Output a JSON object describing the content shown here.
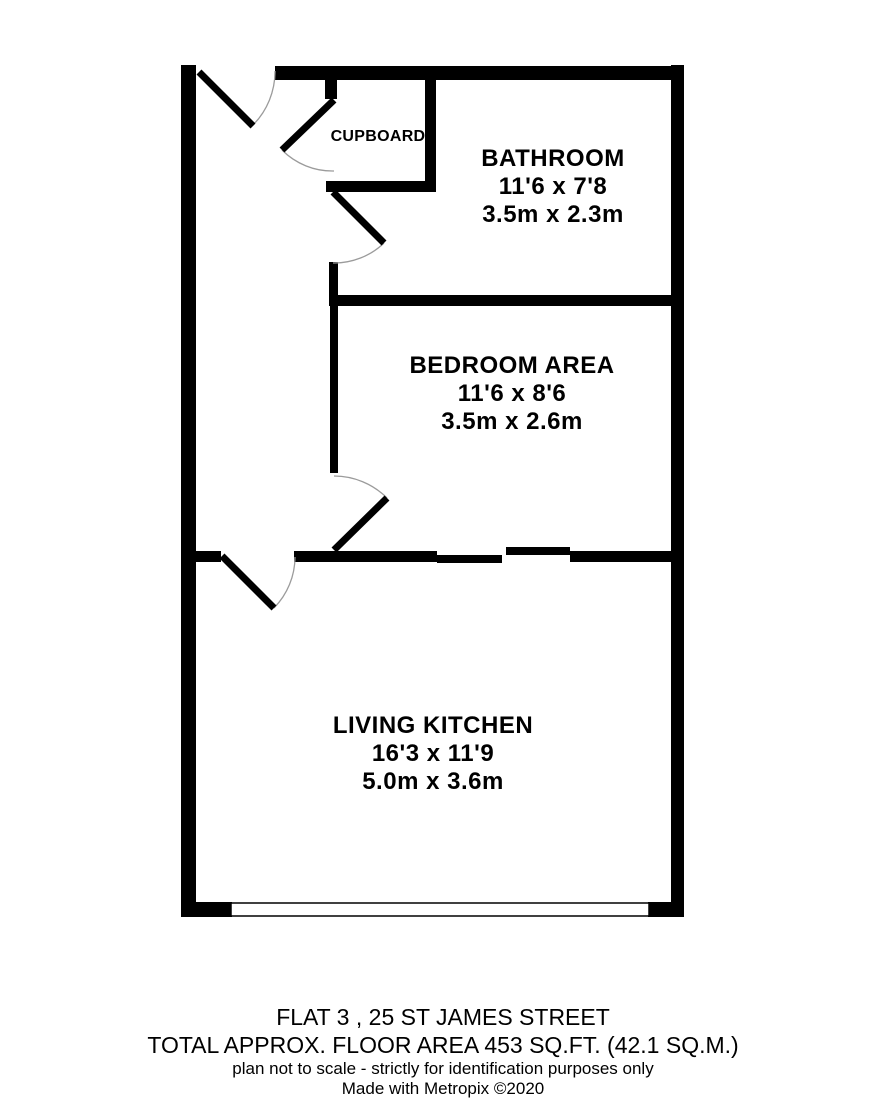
{
  "plan": {
    "rooms": {
      "cupboard": {
        "name": "CUPBOARD"
      },
      "bathroom": {
        "name": "BATHROOM",
        "imperial": "11'6 x 7'8",
        "metric": "3.5m x 2.3m"
      },
      "bedroom": {
        "name": "BEDROOM AREA",
        "imperial": "11'6 x 8'6",
        "metric": "3.5m x 2.6m"
      },
      "living": {
        "name": "LIVING KITCHEN",
        "imperial": "16'3 x 11'9",
        "metric": "5.0m x 3.6m"
      }
    },
    "colors": {
      "wall": "#000000",
      "background": "#ffffff",
      "door_arc": "#9b9b9b",
      "text": "#000000"
    }
  },
  "footer": {
    "line1": "FLAT 3 , 25 ST JAMES STREET",
    "line2": "TOTAL APPROX. FLOOR AREA 453 SQ.FT. (42.1 SQ.M.)",
    "line3": "plan not to scale - strictly for identification purposes only",
    "line4": "Made with Metropix ©2020"
  }
}
